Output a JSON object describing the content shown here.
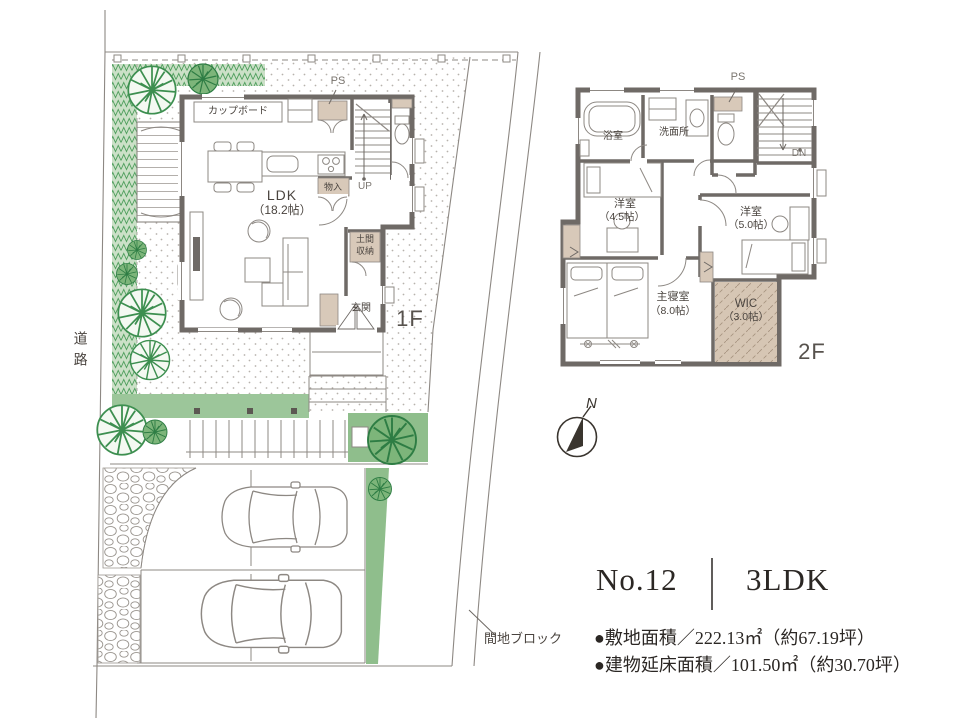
{
  "floorplan": {
    "site": {
      "road_vertical": "道路",
      "block_label": "間地ブロック"
    },
    "floor1": {
      "floor_label": "1F",
      "cupboard": "カップボード",
      "ps": "PS",
      "ldk_name": "LDK",
      "ldk_size": "（18.2帖）",
      "closet": "物入",
      "stairs_up": "UP",
      "doma_line1": "土間",
      "doma_line2": "収納",
      "entrance": "玄関"
    },
    "floor2": {
      "floor_label": "2F",
      "ps": "PS",
      "bath": "浴室",
      "washroom": "洗面所",
      "stairs_down": "DN",
      "western_room1_name": "洋室",
      "western_room1_size": "（4.5帖）",
      "western_room2_name": "洋室",
      "western_room2_size": "（5.0帖）",
      "master_name": "主寝室",
      "master_size": "（8.0帖）",
      "wic_name": "WIC",
      "wic_size": "（3.0帖）"
    },
    "compass": {
      "north": "N"
    }
  },
  "info": {
    "plan_number": "No.12",
    "plan_type": "3LDK",
    "site_area": "●敷地面積／222.13㎡（約67.19坪）",
    "floor_area": "●建物延床面積／101.50㎡（約30.70坪）"
  },
  "colors": {
    "wall": "#6f6a66",
    "tan": "#d8c9b9",
    "line": "#8d8883",
    "green_dark": "#3d8f50",
    "lawn": "#9cc69a",
    "planter": "#8fbe8c"
  }
}
